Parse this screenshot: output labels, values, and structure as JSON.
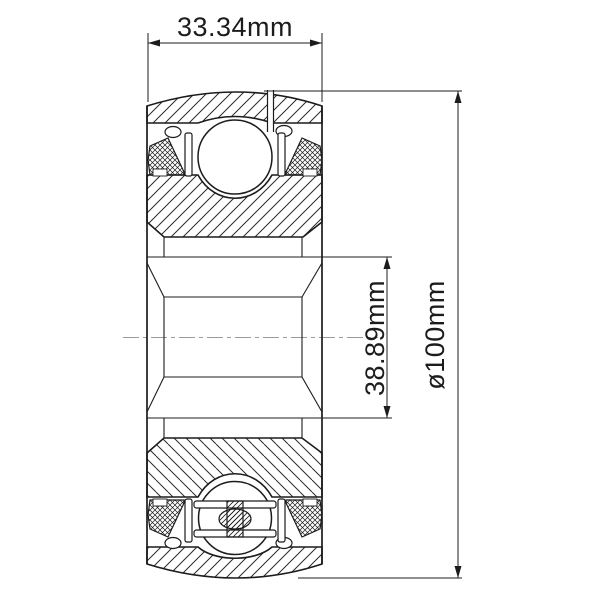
{
  "dimensions": {
    "width_label": "33.34mm",
    "bore_label": "38.89mm",
    "od_label": "ø100mm"
  },
  "colors": {
    "line": "#1c1c1c",
    "hatch": "#2b2b2b",
    "centerline": "#9a9a9a",
    "background": "#ffffff"
  }
}
